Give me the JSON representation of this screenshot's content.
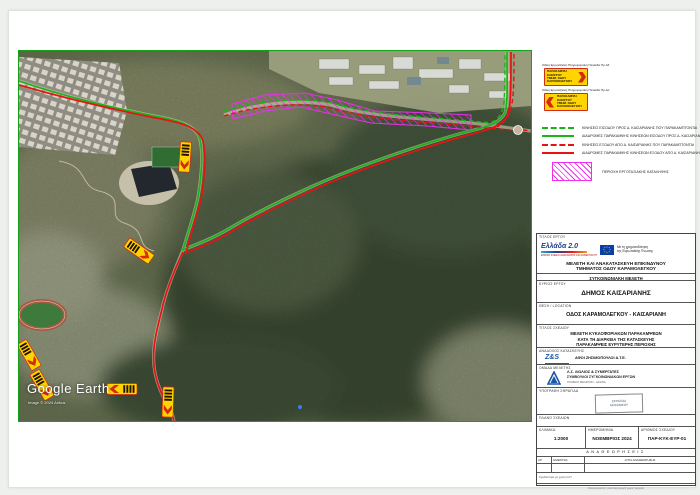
{
  "map": {
    "attribution_logo": "Google Earth",
    "attribution_credit": "Image © 2024 Airbus",
    "border_color": "#15a315"
  },
  "legend": {
    "sign1_caption": "Οδική Εργοταξιακή Πληροφοριακή Πινακίδα Πρ-4δ",
    "sign2_caption": "Οδική Εργοταξιακή Πληροφοριακή Πινακίδα Πρ-4α",
    "sign_lines": [
      "ΠΑΡΑΚΑΜΨΗ",
      "ΚΛΕΙΣΤΟΥ",
      "ΤΜΗΜ. ΟΔΟΥ",
      "ΚΑΡΑΜΟΛΕΓΚΟΥ"
    ],
    "items": [
      {
        "style": "green-dashed",
        "label": "ΚΙΝΗΣΕΙΣ ΕΙΣΟΔΟΥ ΠΡΟΣ Δ. ΚΑΙΣΑΡΙΑΝΗΣ ΠΟΥ ΠΑΡΑΚΑΜΠΤΟΝΤΑΙ"
      },
      {
        "style": "green-solid",
        "label": "ΔΙΑΔΡΟΜΕΣ ΠΑΡΑΚΑΜΨΗΣ ΚΙΝΗΣΕΩΝ ΕΙΣΟΔΟΥ ΠΡΟΣ Δ. ΚΑΙΣΑΡΙΑΝΗΣ"
      },
      {
        "style": "red-dashed",
        "label": "ΚΙΝΗΣΕΙΣ ΕΞΟΔΟΥ ΑΠΟ Δ. ΚΑΙΣΑΡΙΑΝΗΣ ΠΟΥ ΠΑΡΑΚΑΜΠΤΟΝΤΑΙ"
      },
      {
        "style": "red-solid",
        "label": "ΔΙΑΔΡΟΜΕΣ ΠΑΡΑΚΑΜΨΗΣ ΚΙΝΗΣΕΩΝ ΕΞΟΔΟΥ ΑΠΟ Δ. ΚΑΙΣΑΡΙΑΝΗΣ"
      }
    ],
    "area_label": "ΠΕΡΙΟΧΗ ΕΡΓΟΤΑΞΙΑΚΗΣ ΚΑΤΑΛΗΨΗΣ"
  },
  "title_block": {
    "project_label": "ΤΙΤΛΟΣ ΕΡΓΟΥ",
    "hellas_logo": "Ελλάδα 2.0",
    "hellas_logo_sub": "ΕΘΝΙΚΟ ΣΧΕΔΙΟ ΑΝΑΚΑΜΨΗΣ ΚΑΙ ΑΝΘΕΚΤΙΚΟΤΗΤΑΣ",
    "eu_text1": "Με τη χρηματοδότηση",
    "eu_text2": "της Ευρωπαϊκής Ένωσης",
    "project_title1": "ΜΕΛΕΤΗ ΚΑΙ ΑΝΑΚΑΤΑΣΚΕΥΗ ΕΠΙΚΙΝΔΥΝΟΥ",
    "project_title2": "ΤΜΗΜΑΤΟΣ ΟΔΟΥ ΚΑΡΑΜΟΛΕΓΚΟΥ",
    "study_type": "ΣΥΓΚΟΙΝΩΝΙΑΚΗ ΜΕΛΕΤΗ",
    "owner_label": "ΚΥΡΙΟΣ ΕΡΓΟΥ",
    "owner": "ΔΗΜΟΣ ΚΑΙΣΑΡΙΑΝΗΣ",
    "location_label": "ΘΕΣΗ / LOCATION",
    "location": "ΟΔΟΣ ΚΑΡΑΜΟΛΕΓΚΟΥ - ΚΑΙΣΑΡΙΑΝΗ",
    "drawing_label": "ΤΙΤΛΟΣ ΣΧΕΔΙΟΥ",
    "drawing_title1": "ΜΕΛΕΤΗ ΚΥΚΛΟΦΟΡΙΑΚΩΝ ΠΑΡΑΚΑΜΨΕΩΝ",
    "drawing_title2": "ΚΑΤΑ ΤΗ ΔΙΑΡΚΕΙΑ ΤΗΣ ΚΑΤΑΣΚΕΥΗΣ",
    "drawing_title3": "ΠΑΡΑΚΑΜΨΕΙΣ ΕΥΡΥΤΕΡΗΣ ΠΕΡΙΟΧΗΣ",
    "contractor_label": "ΑΝΑΔΟΧΟΣ ΚΑΤΑΣΚΕΥΗΣ",
    "contractor_logo": "Z&S",
    "contractor": "ΑΦΟΙ ΖΗΣΙΜΟΠΟΥΛΟΙ Α.Τ.Ε.",
    "team_label": "ΟΜΑΔΑ ΜΕΛΕΤΗΣ",
    "team_line1": "Λ.Σ. ΛΙΟΛΙΟΣ & ΣΥΝΕΡΓΑΤΕΣ",
    "team_line2": "ΣΥΜΒΟΥΛΟΙ ΣΥΓΚΟΙΝΩΝΙΑΚΩΝ ΕΡΓΩΝ",
    "team_line3": "ΓΡΑΦΕΙΟ ΜΕΛΕΤΩΝ - ΑΘΗΝΑ",
    "signature_label": "ΥΠΟΓΡΑΦΗ ΣΦΡΑΓΙΔΑ",
    "stamp_line1": "ΣΦΡΑΓΙΔΑ",
    "stamp_line2": "ΜΗΧΑΝΙΚΟΥ",
    "plan_label": "ΠΛΑΝΟ ΣΧΕΔΙΩΝ",
    "scale_label": "ΚΛΙΜΑΚΑ",
    "scale": "1:2000",
    "date_label": "ΗΜΕΡΟΜΗΝΙΑ",
    "date": "ΝΟΕΜΒΡΙΟΣ 2024",
    "number_label": "ΑΡΙΘΜΟΣ ΣΧΕΔΙΟΥ",
    "number": "ΠΑΡ-ΚΥΚ-ΕΥΡ-01",
    "revisions_header": "ΑΝΑΘΕΩΡΗΣΕΙΣ",
    "rev_col1": "ΑΡ.",
    "rev_col2": "ΗΜΕΡ/ΝΙΑ",
    "rev_col3": "ΑΙΤΙΑ ΑΝΑΘΕΩΡΗΣΗΣ",
    "rev_note1": "Σχεδιάστηκε με χρήση Η/Υ",
    "rev_note2": "Απαγορεύεται η αναπαραγωγή χωρίς έγκριση"
  },
  "colors": {
    "route_green": "#17b517",
    "route_red": "#e41414",
    "worksite_magenta": "#ee2fee",
    "sign_yellow": "#ffd400",
    "sign_red": "#d42a10"
  }
}
